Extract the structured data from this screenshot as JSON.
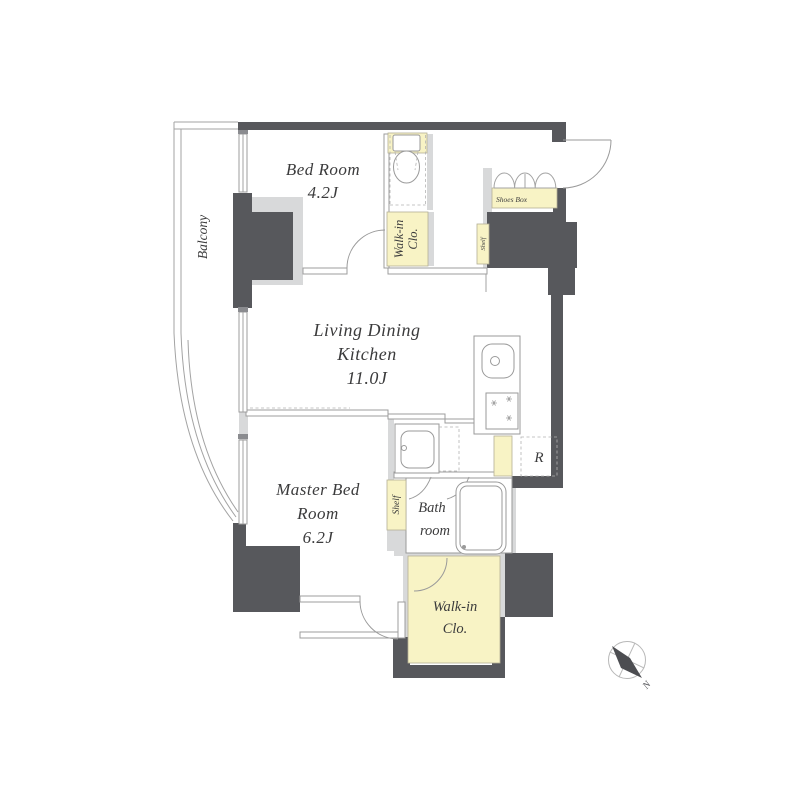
{
  "plan": {
    "rooms": {
      "balcony": {
        "label": "Balcony"
      },
      "bedroom": {
        "line1": "Bed Room",
        "line2": "4.2J"
      },
      "ldk": {
        "line1": "Living Dining",
        "line2": "Kitchen",
        "line3": "11.0J"
      },
      "master": {
        "line1": "Master Bed",
        "line2": "Room",
        "line3": "6.2J"
      },
      "bath": {
        "line1": "Bath",
        "line2": "room"
      },
      "wic_top": {
        "line1": "Walk-in",
        "line2": "Clo."
      },
      "wic_bottom": {
        "line1": "Walk-in",
        "line2": "Clo."
      },
      "shoes_box": {
        "label": "Shoes Box"
      },
      "shelf_entrance": {
        "label": "Shelf"
      },
      "shelf_master": {
        "label": "Shelf"
      }
    },
    "fixtures": {
      "fridge_label": "R"
    },
    "compass": {
      "north_label": "N"
    },
    "colors": {
      "wall_dark": "#57585c",
      "wall_light": "#d8d9da",
      "closet_yellow": "#f8f3c5",
      "line_gray": "#9c9c9c",
      "text": "#3b3b3c"
    }
  }
}
